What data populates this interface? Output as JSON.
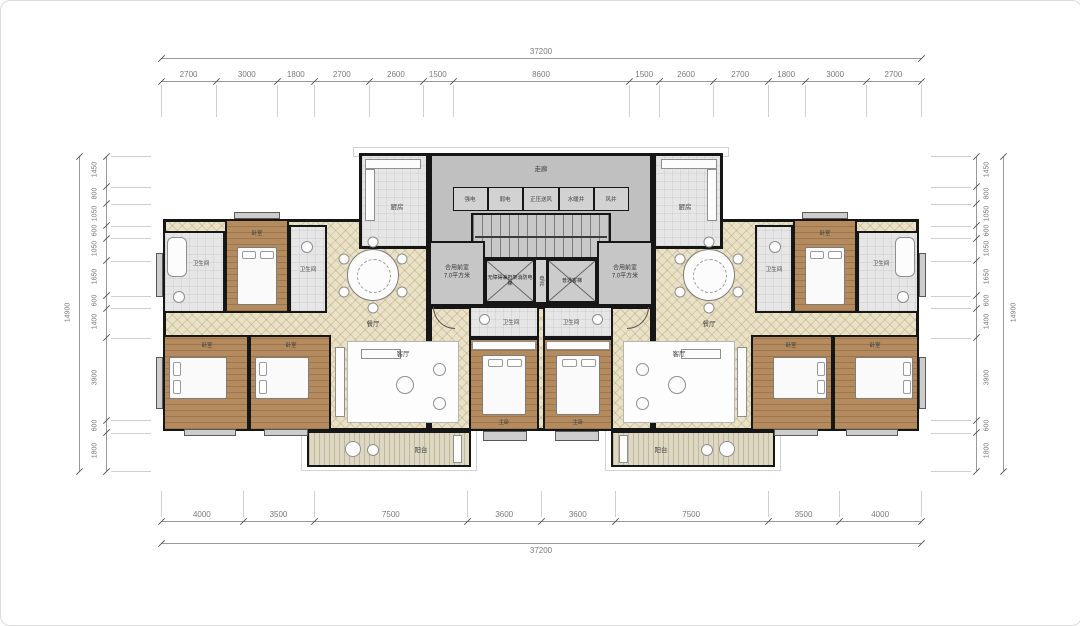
{
  "dimensions": {
    "top": {
      "total": "37200",
      "segments": [
        "2700",
        "3000",
        "1800",
        "2700",
        "2600",
        "1500",
        "8600",
        "1500",
        "2600",
        "2700",
        "1800",
        "3000",
        "2700"
      ]
    },
    "bottom": {
      "total": "37200",
      "segments": [
        "4000",
        "3500",
        "7500",
        "3600",
        "3600",
        "7500",
        "3500",
        "4000"
      ]
    },
    "left": {
      "total": "14900",
      "segments": [
        "1450",
        "800",
        "1050",
        "600",
        "1050",
        "1650",
        "600",
        "1400",
        "3900",
        "600",
        "1800"
      ]
    },
    "right": {
      "total": "14900",
      "segments": [
        "1450",
        "800",
        "1050",
        "600",
        "1050",
        "1650",
        "600",
        "1400",
        "3900",
        "600",
        "1800"
      ]
    }
  },
  "core": {
    "corridor_label": "走廊",
    "shaft_labels": [
      "强电",
      "弱电",
      "正压送风",
      "水暖井",
      "风井"
    ],
    "elevator_left_label": "无障碍兼担架消防电梯",
    "elevator_right_label": "普通客梯",
    "mid_shaft_label": "电井",
    "front_room_line1": "合用前室",
    "front_room_line2": "7.0平方米"
  },
  "rooms": {
    "kitchen": "厨房",
    "dining": "餐厅",
    "living": "客厅",
    "balcony": "阳台",
    "bedroom": "卧室",
    "master_bedroom": "主卧",
    "bathroom": "卫生间"
  },
  "colors": {
    "wall": "#161616",
    "core_floor": "#c1c0c0",
    "living_floor": "#eae2c8",
    "wood_floor": "#b38b5e",
    "bath_floor": "#e6e6e6",
    "balcony_floor": "#ded8c2"
  }
}
